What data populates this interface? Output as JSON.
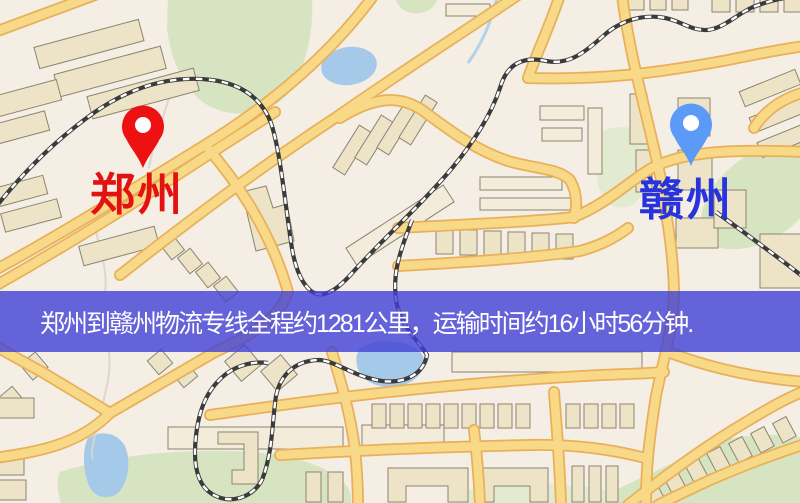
{
  "map": {
    "markers": [
      {
        "id": "origin",
        "label": "郑州",
        "label_color": "#e31212",
        "pin_color": "#ee1111",
        "pin_hole_color": "#ffffff",
        "x": 143,
        "y": 126
      },
      {
        "id": "destination",
        "label": "赣州",
        "label_color": "#2733dd",
        "pin_color": "#5b9bf7",
        "pin_hole_color": "#ffffff",
        "x": 691,
        "y": 124
      }
    ]
  },
  "banner": {
    "text": "郑州到赣州物流专线全程约1281公里，运输时间约16小时56分钟.",
    "background_color": "rgba(64,64,214,0.8)",
    "text_color": "#ffffff"
  }
}
